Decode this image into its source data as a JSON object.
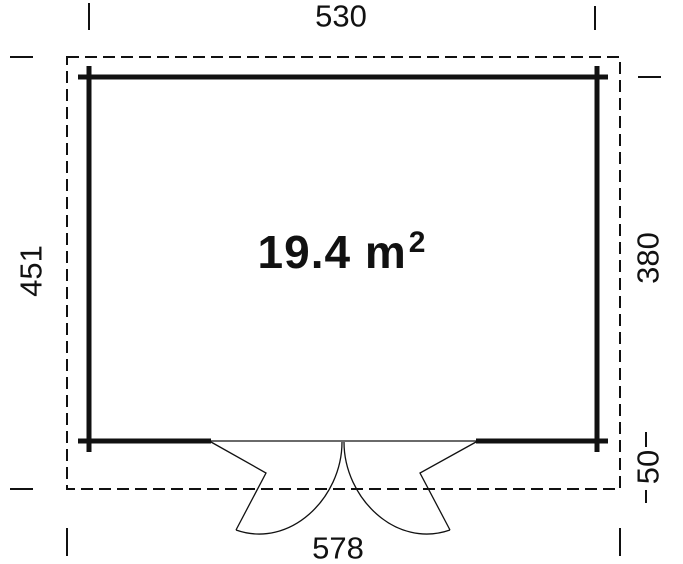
{
  "plan": {
    "area_label": {
      "text": "19.4 m",
      "superscript": "2"
    },
    "dimensions": {
      "top_wall_width": "530",
      "left_total_depth": "451",
      "right_wall_depth": "380",
      "right_overhang": "50",
      "bottom_total_width": "578"
    },
    "colors": {
      "ink": "#111111",
      "background": "#ffffff"
    }
  }
}
